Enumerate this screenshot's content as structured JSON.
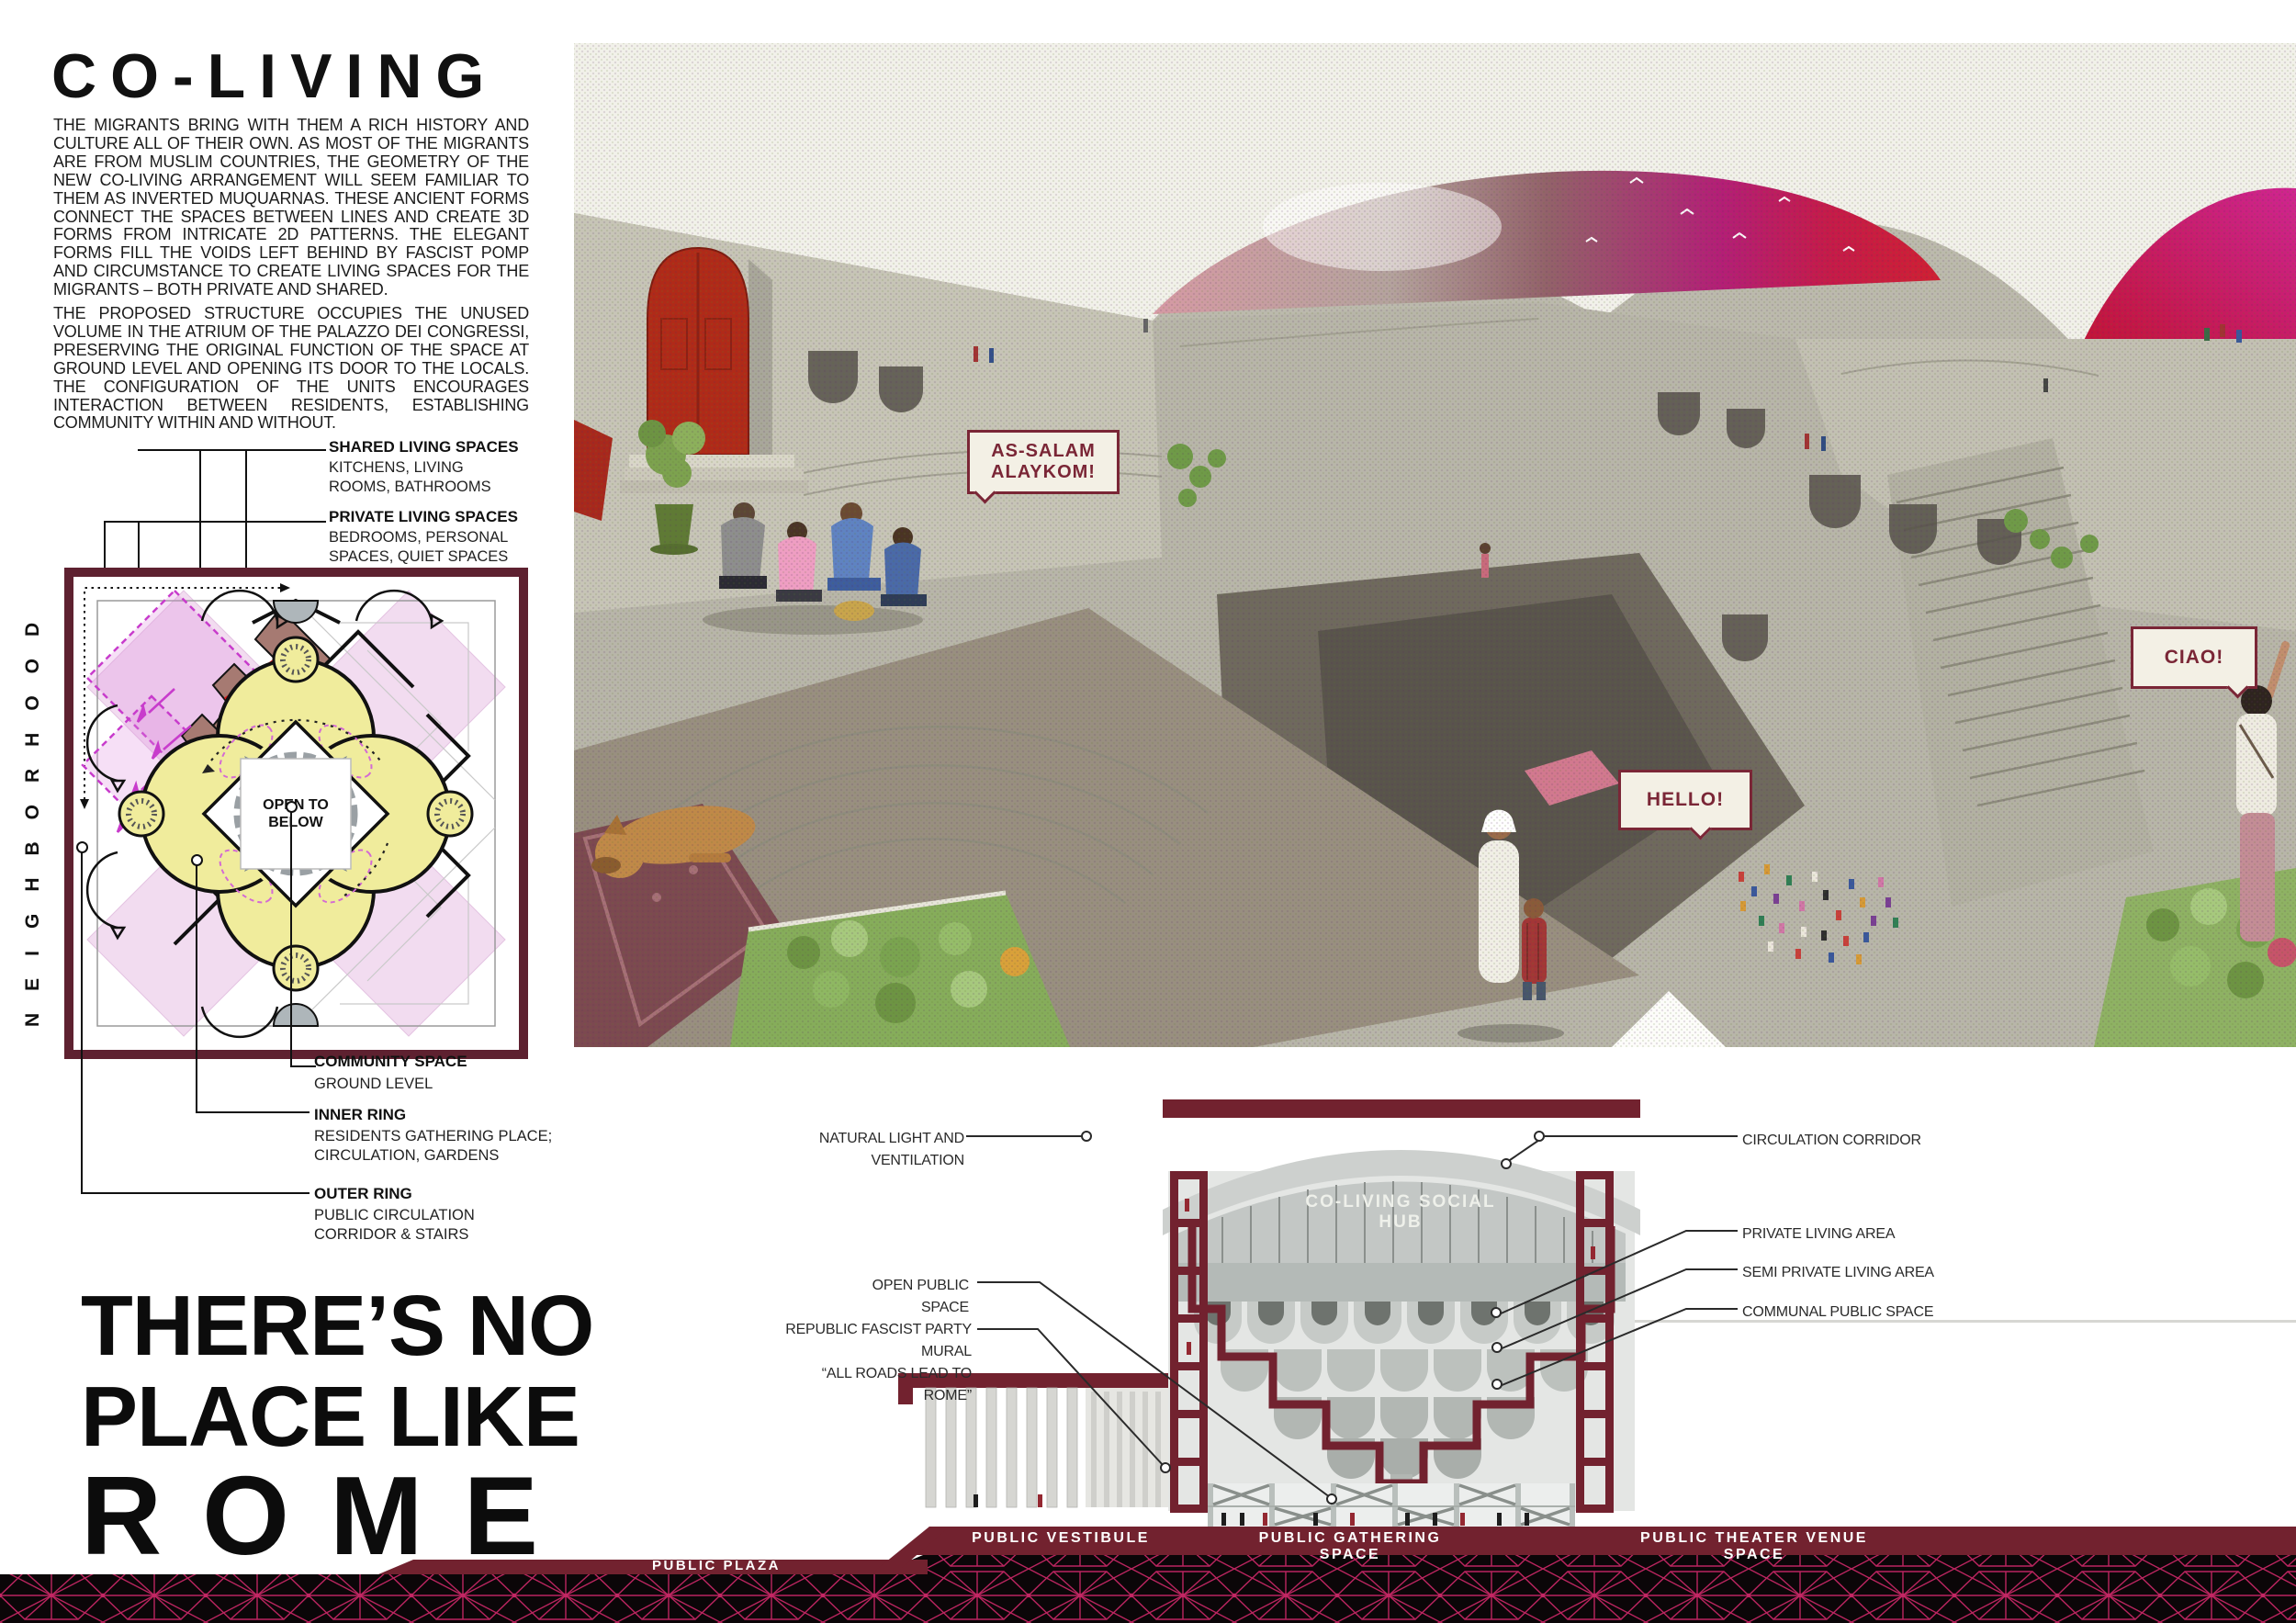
{
  "poster": {
    "title": "CO-LIVING",
    "intro_par_1": "THE MIGRANTS BRING WITH THEM A RICH HISTORY AND CULTURE ALL OF THEIR OWN. AS MOST OF THE MIGRANTS ARE FROM MUSLIM COUNTRIES, THE GEOMETRY OF THE NEW CO-LIVING ARRANGEMENT WILL SEEM FAMILIAR TO THEM AS INVERTED MUQUARNAS. THESE ANCIENT FORMS CONNECT THE SPACES BETWEEN LINES AND CREATE 3D FORMS FROM INTRICATE 2D PATTERNS. THE ELEGANT FORMS FILL THE VOIDS LEFT BEHIND BY FASCIST POMP AND CIRCUMSTANCE TO CREATE LIVING SPACES FOR THE MIGRANTS – BOTH PRIVATE AND SHARED.",
    "intro_par_2": "THE PROPOSED STRUCTURE OCCUPIES THE UNUSED VOLUME IN THE ATRIUM OF THE PALAZZO DEI CONGRESSI, PRESERVING THE ORIGINAL FUNCTION OF THE SPACE AT GROUND LEVEL AND OPENING ITS DOOR TO THE LOCALS. THE CONFIGURATION OF THE UNITS ENCOURAGES INTERACTION BETWEEN RESIDENTS, ESTABLISHING COMMUNITY WITHIN AND WITHOUT.",
    "tagline_line1": "THERE’S NO",
    "tagline_line2": "PLACE LIKE",
    "tagline_line3": "ROME"
  },
  "plan": {
    "neighborhood_label": "NEIGHBORHOOD",
    "open_to_below": "OPEN TO\nBELOW",
    "callouts": {
      "shared": {
        "title": "SHARED LIVING SPACES",
        "desc": "KITCHENS, LIVING\nROOMS, BATHROOMS"
      },
      "private": {
        "title": "PRIVATE LIVING SPACES",
        "desc": "BEDROOMS, PERSONAL\nSPACES, QUIET SPACES"
      },
      "community": {
        "title": "COMMUNITY SPACE",
        "desc": "GROUND LEVEL"
      },
      "inner_ring": {
        "title": "INNER RING",
        "desc": "RESIDENTS GATHERING PLACE;\nCIRCULATION, GARDENS"
      },
      "outer_ring": {
        "title": "OUTER RING",
        "desc": "PUBLIC CIRCULATION\nCORRIDOR & STAIRS"
      }
    }
  },
  "render": {
    "bubble_arabic": "AS-SALAM\nALAYKOM!",
    "bubble_english": "HELLO!",
    "bubble_italian": "CIAO!"
  },
  "section": {
    "hub_sign": "CO-LIVING SOCIAL HUB",
    "labels_left": {
      "natural_light": "NATURAL LIGHT AND VENTILATION",
      "open_public": "OPEN PUBLIC SPACE",
      "mural": "REPUBLIC FASCIST PARTY MURAL\n“ALL ROADS LEAD TO ROME”"
    },
    "labels_right": {
      "circulation": "CIRCULATION CORRIDOR",
      "private": "PRIVATE LIVING AREA",
      "semi_private": "SEMI PRIVATE LIVING AREA",
      "communal": "COMMUNAL PUBLIC SPACE"
    },
    "band_labels": {
      "vestibule": "PUBLIC VESTIBULE",
      "gathering": "PUBLIC GATHERING SPACE",
      "theater": "PUBLIC THEATER  VENUE SPACE",
      "plaza": "PUBLIC PLAZA"
    }
  },
  "colors": {
    "maroon": "#72222f",
    "magenta_lattice": "#c42664",
    "plan_yellow": "#f0ec9c",
    "plan_pink": "#f2dcf0",
    "door_red": "#b02a18"
  }
}
